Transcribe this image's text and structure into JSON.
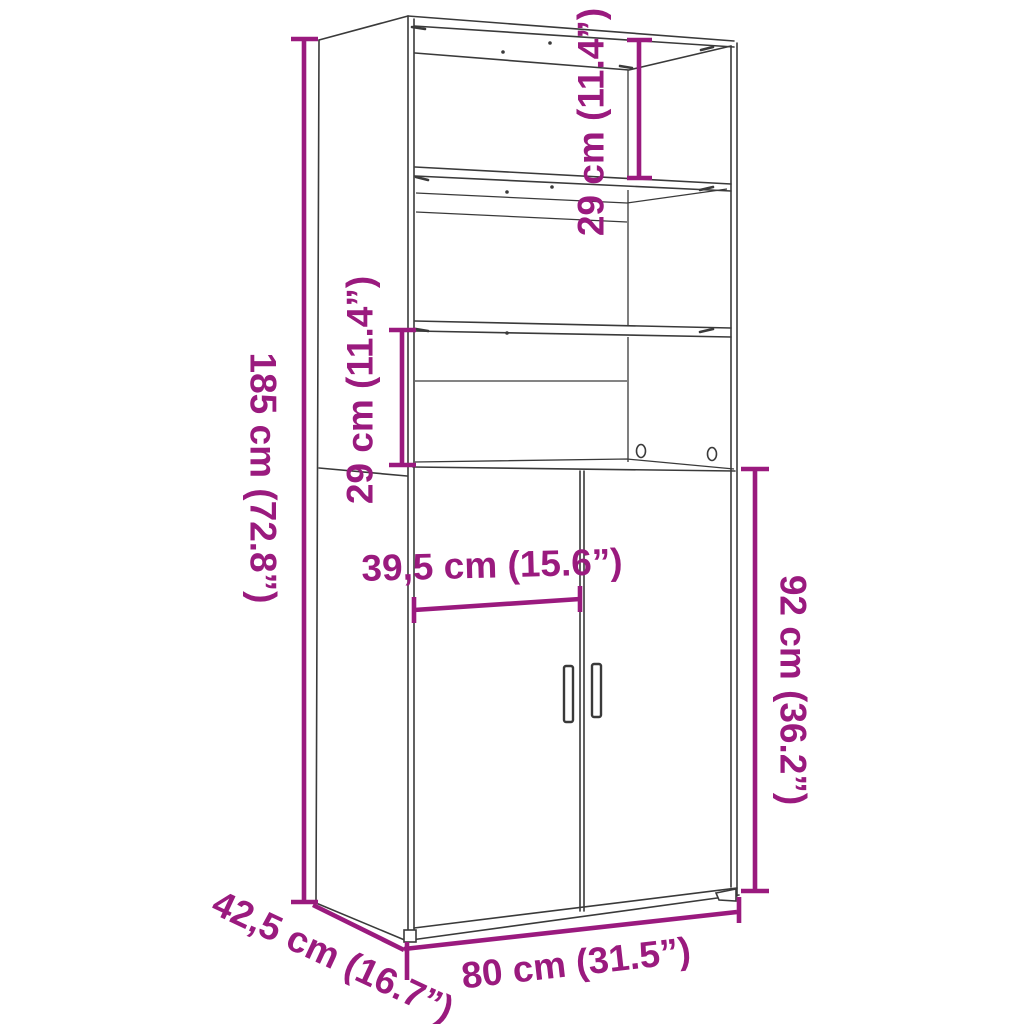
{
  "diagram": {
    "colors": {
      "accent": "#9a1a7e",
      "line": "#3a3a3a",
      "background": "#ffffff"
    },
    "labels": {
      "overall_height": "185 cm (72.8”)",
      "top_shelf_height": "29 cm (11.4”)",
      "middle_shelf_height": "29 cm (11.4”)",
      "door_width": "39,5 cm (15.6”)",
      "lower_section_height": "92 cm (36.2”)",
      "overall_width": "80 cm (31.5”)",
      "overall_depth": "42,5 cm (16.7”)"
    }
  }
}
